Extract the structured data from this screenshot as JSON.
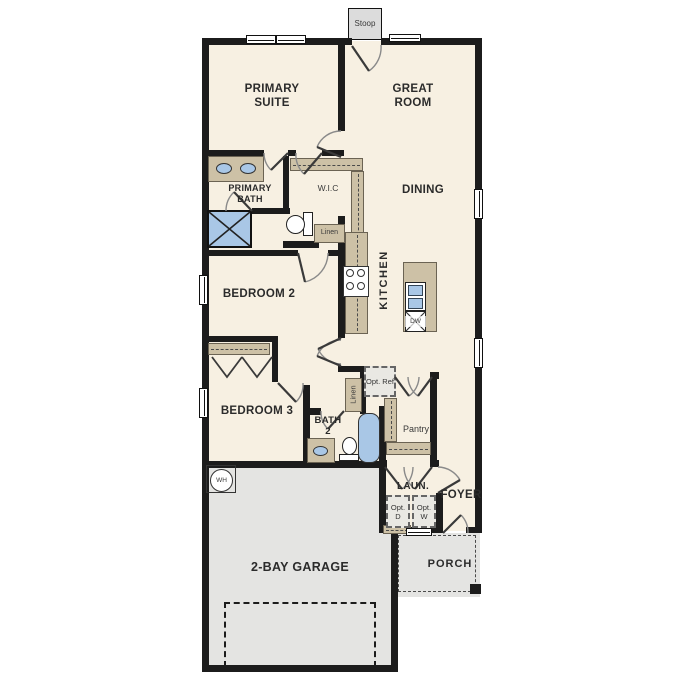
{
  "plan_title": "single story floor plan",
  "labels": {
    "stoop": "Stoop",
    "primary_suite": "PRIMARY SUITE",
    "great_room": "GREAT ROOM",
    "primary_bath": "PRIMARY BATH",
    "wic": "W.I.C",
    "linen_hall": "Linen",
    "dining": "DINING",
    "kitchen": "KITCHEN",
    "dw": "DW",
    "bedroom2": "BEDROOM 2",
    "bedroom3": "BEDROOM 3",
    "bath2": "BATH 2",
    "linen_bath": "Linen",
    "opt_ref": "Opt. Ref",
    "pantry": "Pantry",
    "laundry": "LAUN.",
    "opt_dryer": "Opt. D",
    "opt_washer": "Opt. W",
    "foyer": "FOYER",
    "garage": "2-BAY GARAGE",
    "porch": "PORCH",
    "water_heater": "WH"
  },
  "colors": {
    "wall": "#1c1c1c",
    "interior_floor": "#f7f0e2",
    "garage_floor": "#e4e4e2",
    "cabinet_tan": "#cdc1a6",
    "plumbing_blue": "#a9c7e6",
    "window_white": "#ffffff"
  }
}
